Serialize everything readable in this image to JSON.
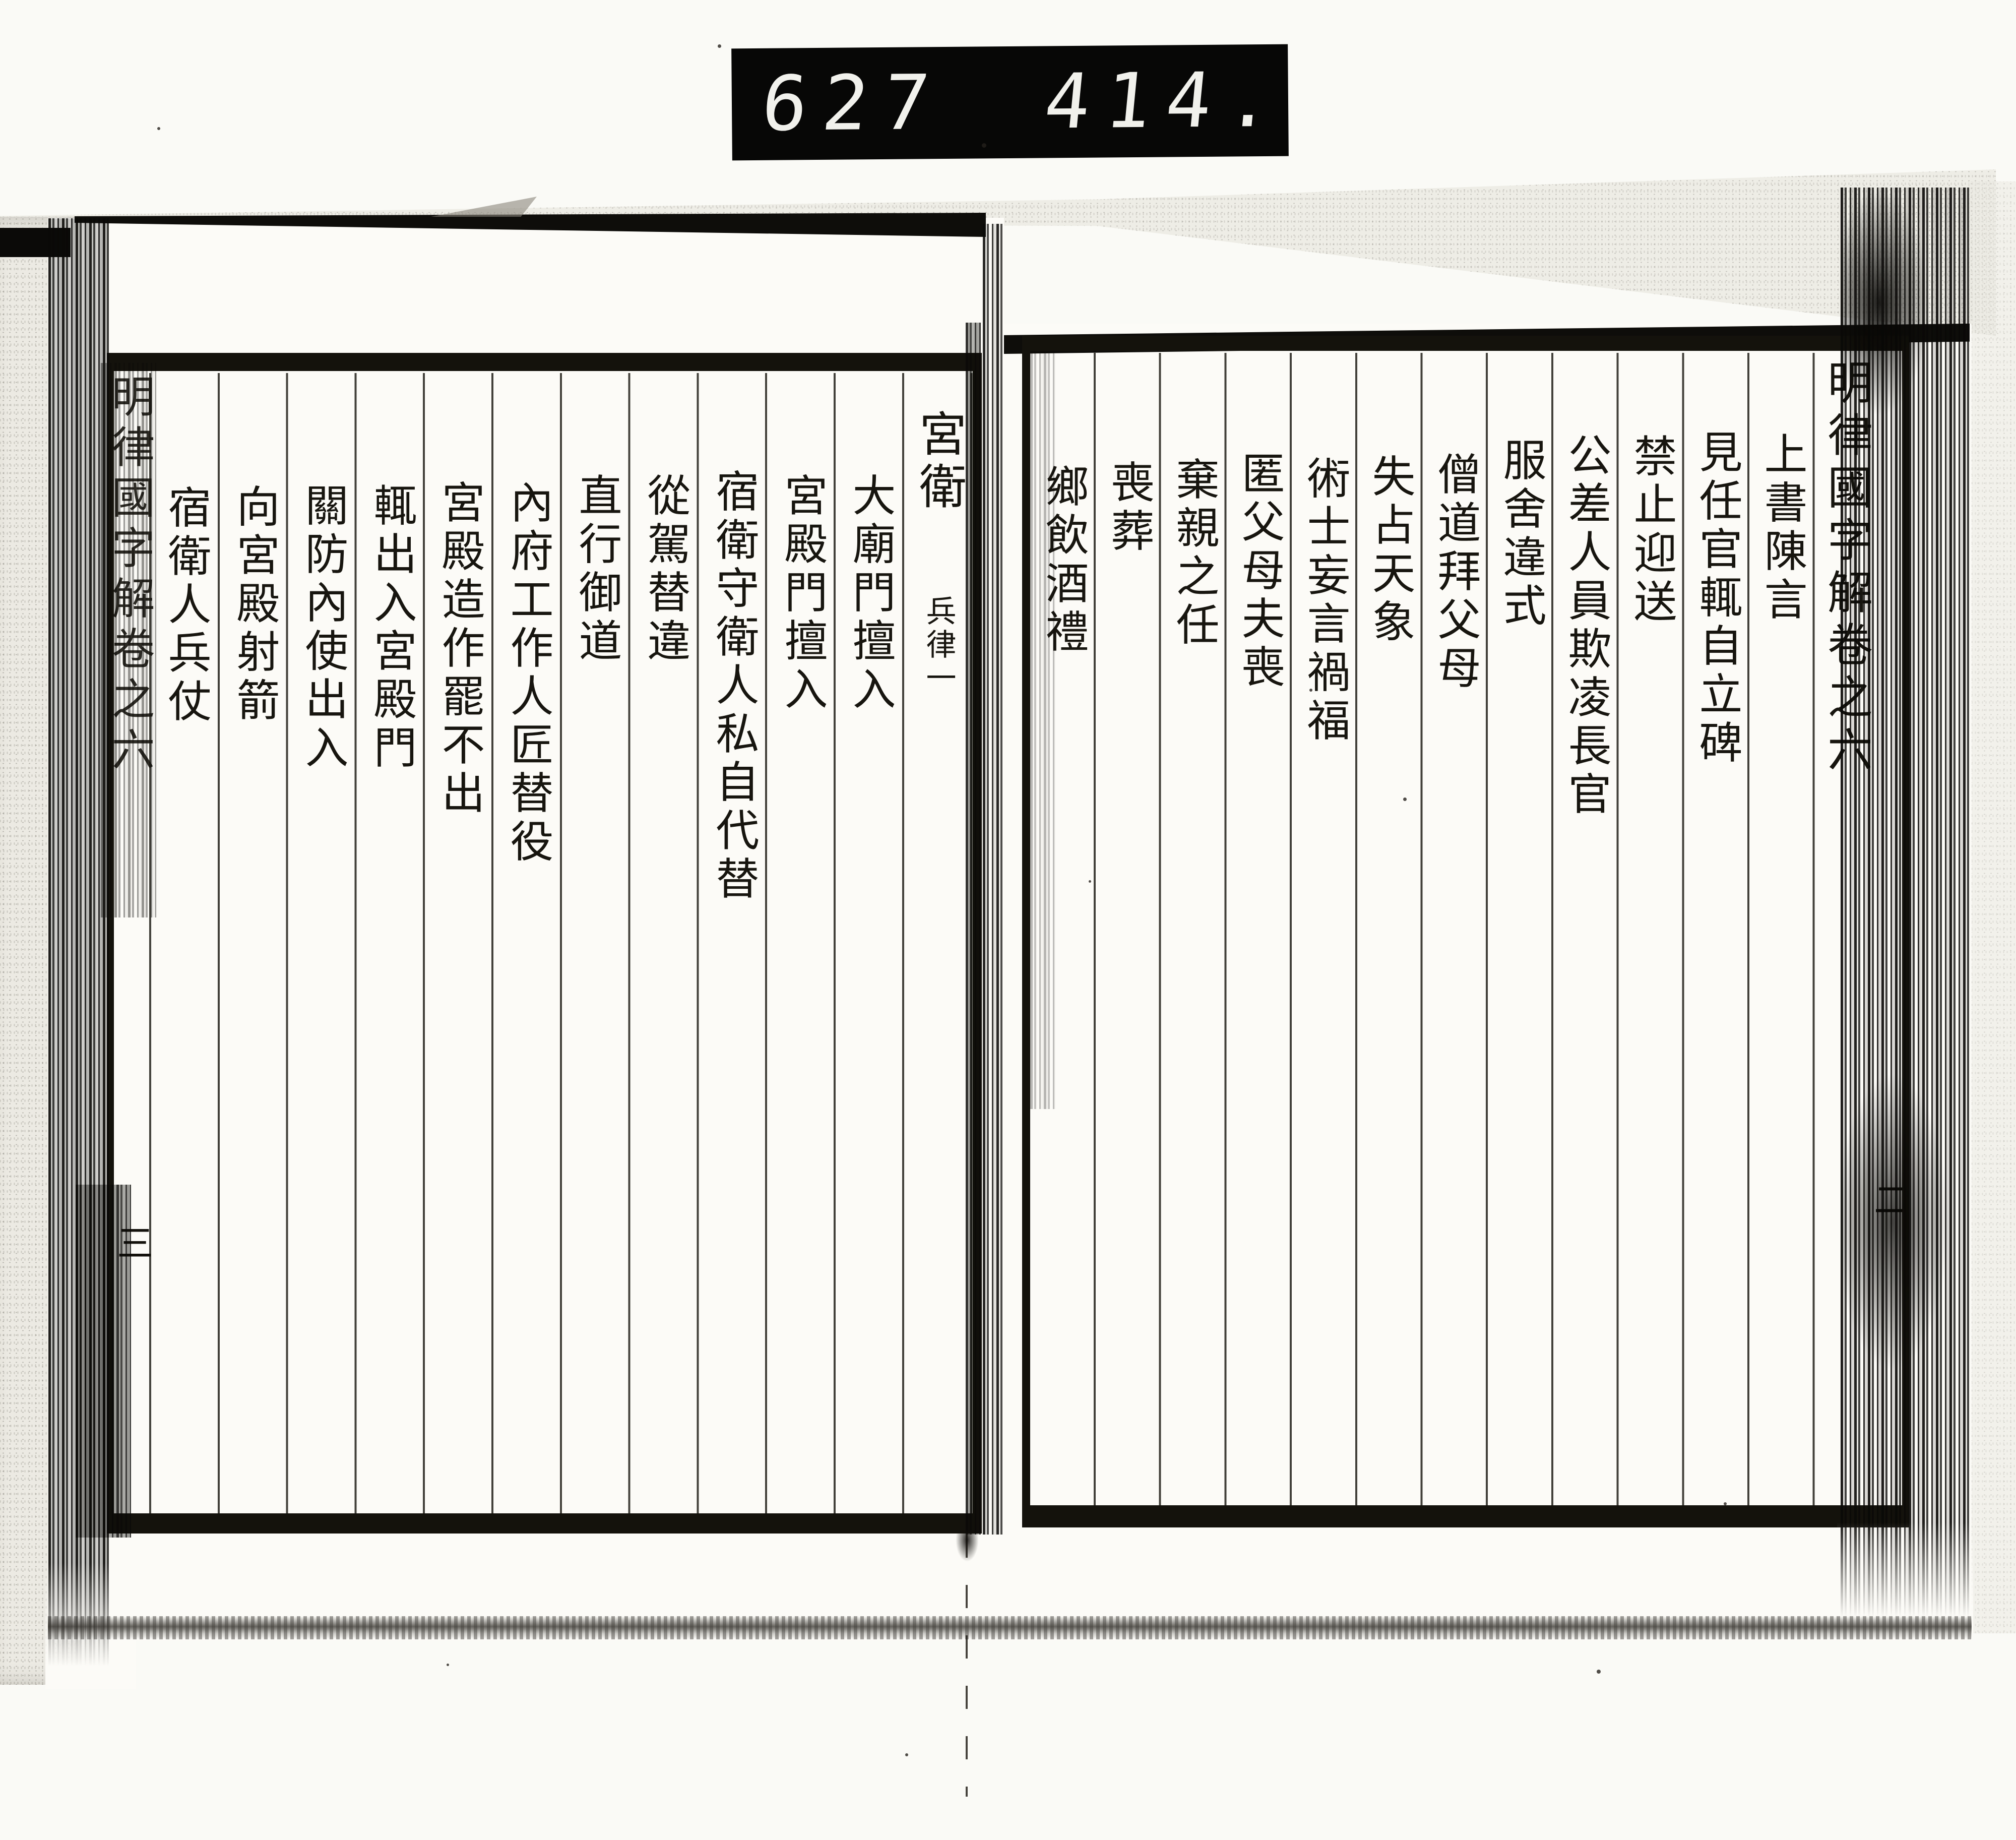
{
  "scan": {
    "counter": {
      "group1": "627",
      "group2": "414."
    },
    "right_page": {
      "banxin_title": "明律國字解卷之六",
      "leaf_number": "二",
      "toc_entries": [
        "上書陳言",
        "見任官輒自立碑",
        "禁止迎送",
        "公差人員欺凌長官",
        "服舍違式",
        "僧道拜父母",
        "失占天象",
        "術士妄言禍福",
        "匿父母夫喪",
        "棄親之任",
        "喪葬",
        "鄉飲酒禮"
      ]
    },
    "left_page": {
      "banxin_title": "明律國字解卷之六",
      "leaf_number": "三",
      "chapter_heading": {
        "main": "宮衛",
        "sub": "兵律一"
      },
      "toc_entries": [
        "大廟門擅入",
        "宮殿門擅入",
        "宿衛守衛人私自代替",
        "從駕替違",
        "直行御道",
        "內府工作人匠替役",
        "宮殿造作罷不出",
        "輒出入宮殿門",
        "關防內使出入",
        "向宮殿射箭",
        "宿衛人兵仗"
      ]
    },
    "colors": {
      "ink": "#17150f",
      "paper": "#fcfbf7",
      "counter_bg": "#070706",
      "digit": "#f1f1ec"
    }
  }
}
